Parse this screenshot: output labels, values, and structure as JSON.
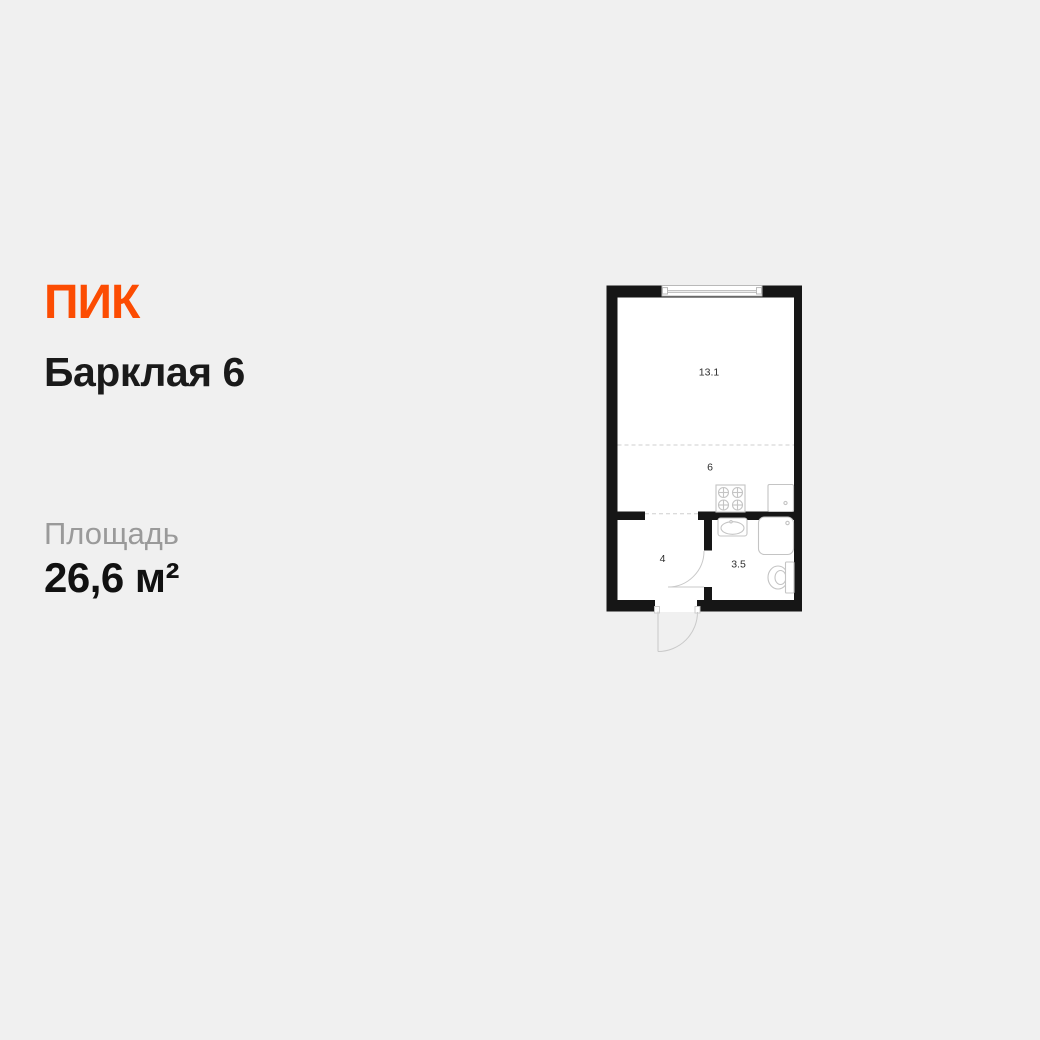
{
  "page": {
    "background_color": "#f0f0f0"
  },
  "brand": {
    "logo_text": "ПИК",
    "logo_color": "#FC4C02"
  },
  "listing": {
    "title": "Барклая 6",
    "area_label": "Площадь",
    "area_value": "26,6 м²"
  },
  "floor_plan": {
    "total_area_m2": "26,6",
    "wall_color": "#161616",
    "interior_color": "#ffffff",
    "fixture_stroke_color": "#c4c4c4",
    "dashed_line_color": "#cfcfcf",
    "rooms": [
      {
        "name": "living-room",
        "area_label": "13.1"
      },
      {
        "name": "kitchen",
        "area_label": "6"
      },
      {
        "name": "hallway",
        "area_label": "4"
      },
      {
        "name": "bathroom",
        "area_label": "3.5"
      }
    ],
    "fixtures": [
      "window",
      "entrance-door",
      "bathroom-door",
      "stove",
      "kitchen-sink",
      "bathroom-sink",
      "shower-tray",
      "toilet"
    ]
  }
}
